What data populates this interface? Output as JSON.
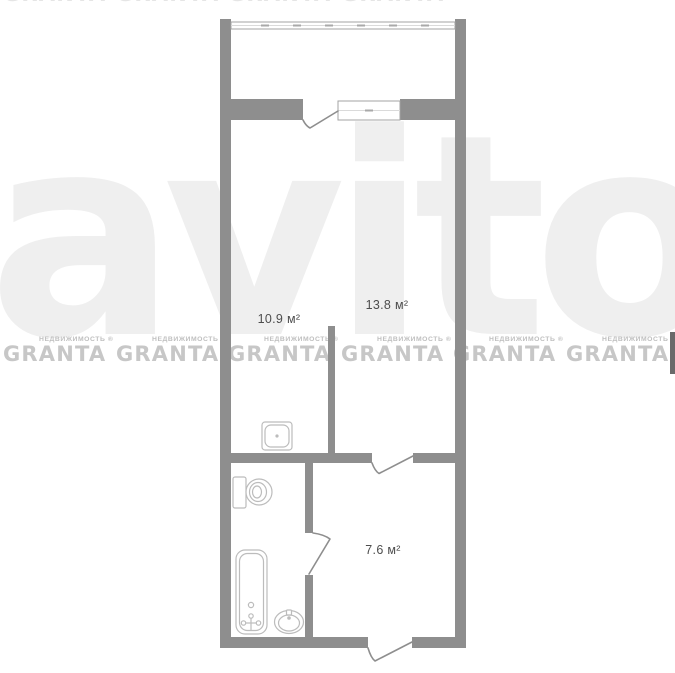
{
  "meta": {
    "type": "apartment-floor-plan"
  },
  "colors": {
    "wall": "#8e8e8e",
    "fixture": "#bcbcbc",
    "label": "#4d4d4d",
    "watermark": "#c7c7c7",
    "watermark_sub": "#bfbfbf",
    "faint": "#efefef"
  },
  "watermark": {
    "brand": "GRANTA",
    "subtitle_full": "НЕДВИЖИМОСТЬ ®",
    "background_brand": "avito"
  },
  "rooms": {
    "kitchen": {
      "area": "10.9 м²"
    },
    "living": {
      "area": "13.8 м²"
    },
    "hall": {
      "area": "7.6 м²"
    }
  },
  "fixtures": {
    "balcony_glazing": "balcony-window-icon",
    "window": "window-icon",
    "doors": "door-swing-icon",
    "kitchen_sink": "sink-icon",
    "toilet": "toilet-icon",
    "bathtub": "bathtub-icon",
    "washbasin": "washbasin-icon"
  }
}
